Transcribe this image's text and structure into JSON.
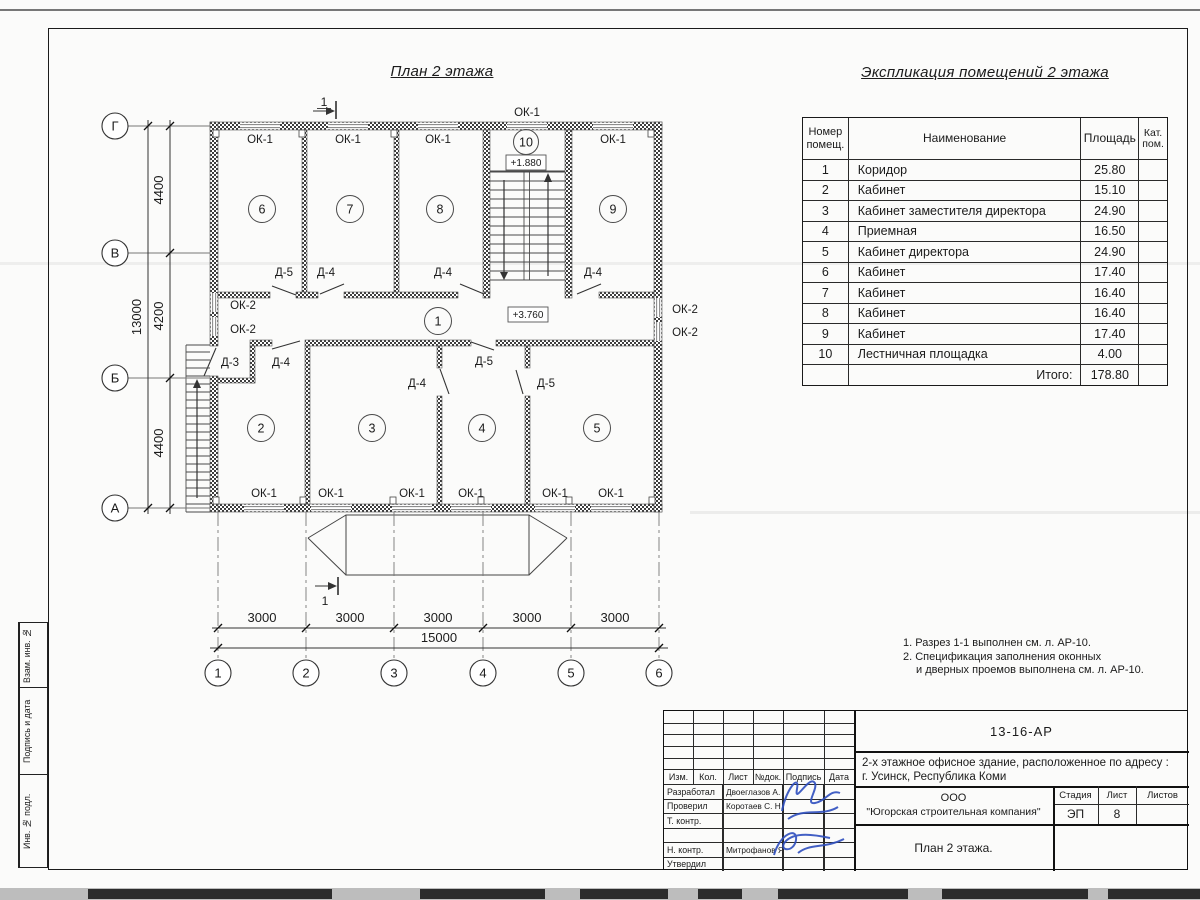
{
  "sheet": {
    "plan_title": "План 2 этажа",
    "explication_title": "Экспликация помещений 2 этажа",
    "notes": [
      "1. Разрез 1-1 выполнен см. л. АР-10.",
      "2. Спецификация заполнения оконных",
      "и дверных проемов выполнена см. л. АР-10."
    ]
  },
  "plan": {
    "window_type_1": "ОК-1",
    "window_type_2": "ОК-2",
    "door_type_3": "Д-3",
    "door_type_4": "Д-4",
    "door_type_5": "Д-5",
    "level_stair": "+1.880",
    "level_corridor": "+3.760",
    "section_number": "1",
    "room_numbers": [
      "1",
      "2",
      "3",
      "4",
      "5",
      "6",
      "7",
      "8",
      "9",
      "10"
    ],
    "row_axes": [
      "Г",
      "В",
      "Б",
      "А"
    ],
    "col_axes": [
      "1",
      "2",
      "3",
      "4",
      "5",
      "6"
    ],
    "dim_v": [
      "4400",
      "4200",
      "4400"
    ],
    "dim_v_total": "13000",
    "dim_h": [
      "3000",
      "3000",
      "3000",
      "3000",
      "3000"
    ],
    "dim_h_total": "15000"
  },
  "explication": {
    "headers": [
      "Номер помещ.",
      "Наименование",
      "Площадь",
      "Кат. пом."
    ],
    "rows": [
      {
        "n": "1",
        "name": "Коридор",
        "area": "25.80"
      },
      {
        "n": "2",
        "name": "Кабинет",
        "area": "15.10"
      },
      {
        "n": "3",
        "name": "Кабинет заместителя директора",
        "area": "24.90"
      },
      {
        "n": "4",
        "name": "Приемная",
        "area": "16.50"
      },
      {
        "n": "5",
        "name": "Кабинет директора",
        "area": "24.90"
      },
      {
        "n": "6",
        "name": "Кабинет",
        "area": "17.40"
      },
      {
        "n": "7",
        "name": "Кабинет",
        "area": "16.40"
      },
      {
        "n": "8",
        "name": "Кабинет",
        "area": "16.40"
      },
      {
        "n": "9",
        "name": "Кабинет",
        "area": "17.40"
      },
      {
        "n": "10",
        "name": "Лестничная площадка",
        "area": "4.00"
      }
    ],
    "total_label": "Итого:",
    "total_area": "178.80"
  },
  "titleblock": {
    "doc_code": "13-16-АР",
    "project_line1": "2-х этажное офисное здание, расположенное по адресу :",
    "project_line2": "г. Усинск, Республика Коми",
    "cols": [
      "Изм.",
      "Кол.",
      "Лист",
      "№док.",
      "Подпись",
      "Дата"
    ],
    "sign_rows": [
      {
        "role": "Разработал",
        "name": "Двоеглазов А. В."
      },
      {
        "role": "Проверил",
        "name": "Коротаев С. Н."
      },
      {
        "role": "Т. контр.",
        "name": ""
      },
      {
        "role": "",
        "name": ""
      },
      {
        "role": "Н. контр.",
        "name": "Митрофанов Я. А."
      },
      {
        "role": "Утвердил",
        "name": ""
      }
    ],
    "org_line1": "ООО",
    "org_line2": "\"Югорская строительная компания\"",
    "stage_label": "Стадия",
    "sheet_label": "Лист",
    "sheets_label": "Листов",
    "stage": "ЭП",
    "sheet_no": "8",
    "drawing_name": "План 2 этажа."
  },
  "margin": {
    "box1": "Взам. инв. №",
    "box2": "Подпись и дата",
    "box3": "Инв. № подл."
  }
}
